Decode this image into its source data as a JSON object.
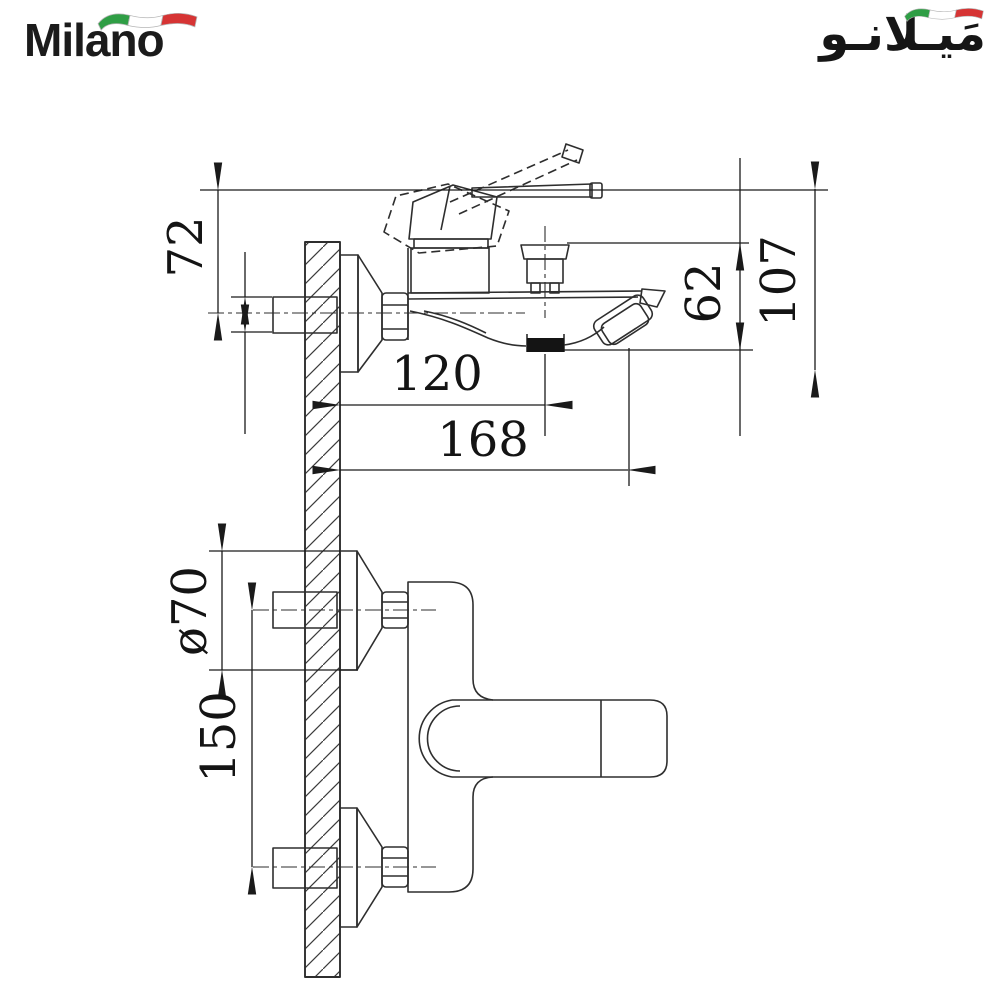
{
  "brand": {
    "name_en": "Milano",
    "name_ar": "مَيـلانـو"
  },
  "flag_icon": {
    "green": "#2f9e45",
    "white": "#ffffff",
    "red": "#d63434",
    "outline": "#b5b5b5"
  },
  "drawing": {
    "line_color": "#2e2e2e",
    "dims": {
      "handle_height": "72",
      "overall_height": "107",
      "spout_to_bottom": "62",
      "aerator_reach": "120",
      "overall_reach": "168",
      "escutcheon_diameter": "ø70",
      "inlet_centers": "150"
    }
  }
}
